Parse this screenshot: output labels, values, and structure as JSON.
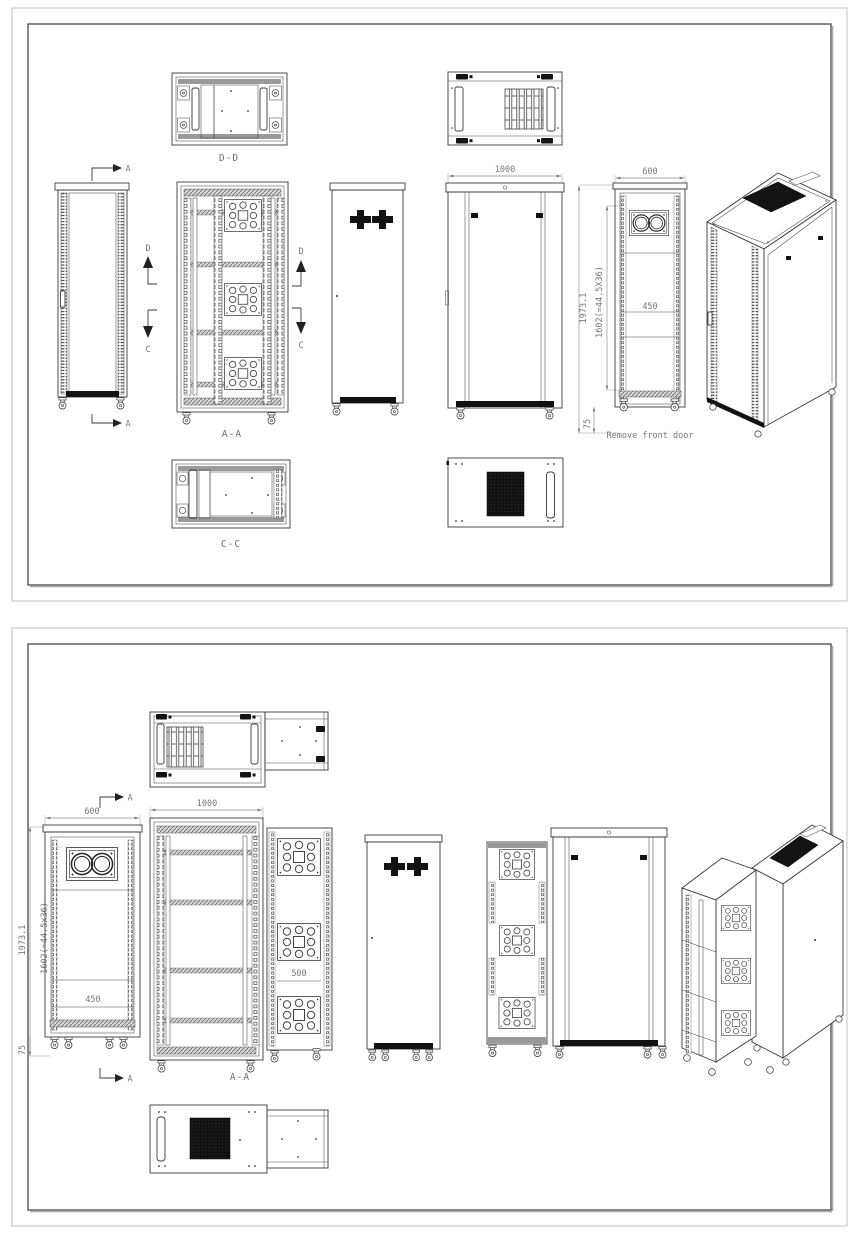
{
  "sheet1": {
    "sections": {
      "dd": "D-D",
      "aa": "A-A",
      "cc": "C-C"
    },
    "arrows": {
      "a": "A",
      "d": "D",
      "c": "C"
    },
    "dims": {
      "depth": "1000",
      "width": "600",
      "height": "1973.1",
      "rack": "1602(=44.5X36)",
      "inner": "450",
      "base": "75"
    },
    "note": "Remove front door"
  },
  "sheet2": {
    "sections": {
      "aa": "A-A"
    },
    "arrows": {
      "a": "A"
    },
    "dims": {
      "width": "600",
      "depth": "1000",
      "height": "1973.1",
      "rack": "1602(=44.5x36)",
      "inner": "450",
      "ext": "500",
      "base": "75"
    }
  },
  "colors": {
    "line": "#3a3a3a",
    "dim_text": "#787878",
    "dark_fill": "#121212",
    "gray_fill": "#9a9a9a",
    "frame_outer": "#c0c0c0",
    "frame_inner": "#555555"
  }
}
